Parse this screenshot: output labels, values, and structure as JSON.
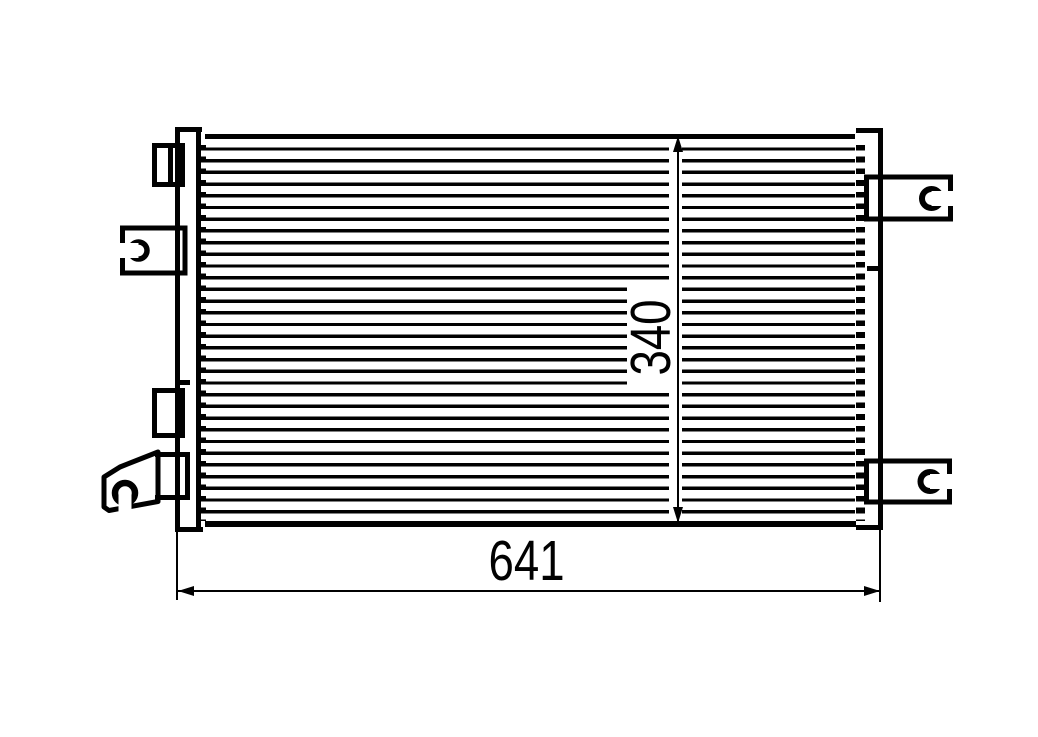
{
  "drawing": {
    "type": "technical-part-drawing",
    "subject": "condenser-with-mounting-brackets",
    "fin_line_count": 33,
    "width_dimension": {
      "value": "641"
    },
    "height_dimension": {
      "value": "340"
    },
    "colors": {
      "line": "#010101",
      "background": "#ffffff"
    }
  }
}
